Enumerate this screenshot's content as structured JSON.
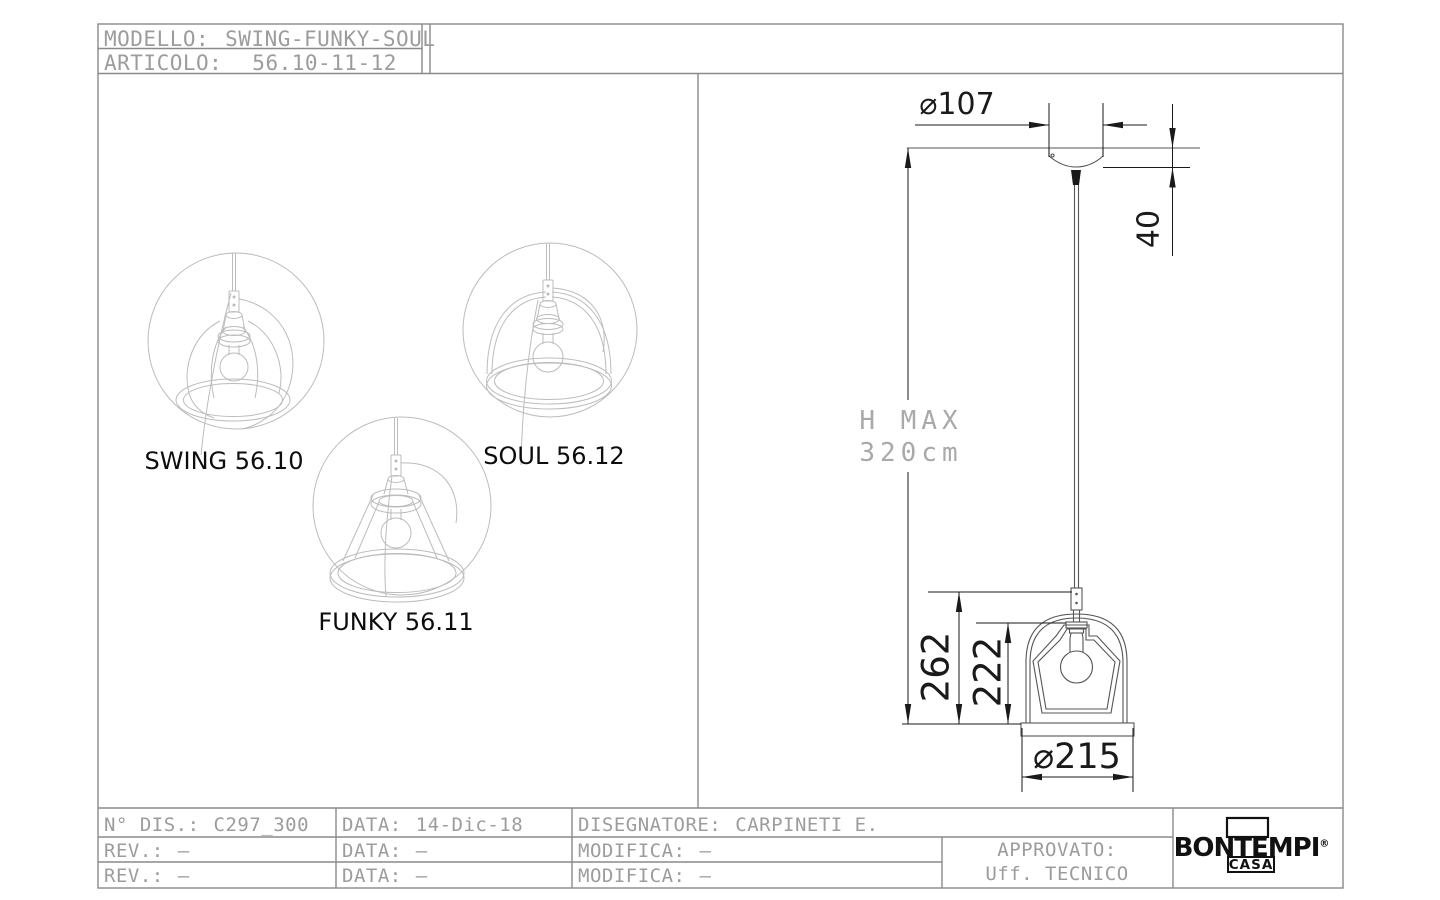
{
  "sheet": {
    "header": {
      "modello_label": "MODELLO:",
      "modello_value": "SWING-FUNKY-SOUL",
      "articolo_label": "ARTICOLO:",
      "articolo_value": "56.10-11-12"
    },
    "products": [
      {
        "label": "SWING 56.10"
      },
      {
        "label": "SOUL 56.12"
      },
      {
        "label": "FUNKY 56.11"
      }
    ],
    "dims": {
      "canopy_diameter": "⌀107",
      "canopy_drop": "40",
      "hmax_line1": "H MAX",
      "hmax_line2": "320cm",
      "height_total": "262",
      "height_glass": "222",
      "base_diameter": "⌀215"
    },
    "title_block": {
      "r1c1_label": "N° DIS.:",
      "r1c1_value": "C297_300",
      "r1c2_label": "DATA:",
      "r1c2_value": "14-Dic-18",
      "r1c3_label": "DISEGNATORE:",
      "r1c3_value": "CARPINETI E.",
      "r2c1_label": "REV.:",
      "r2c1_value": "–",
      "r2c2_label": "DATA:",
      "r2c2_value": "–",
      "r2c3_label": "MODIFICA:",
      "r2c3_value": "–",
      "r3c1_label": "REV.:",
      "r3c1_value": "–",
      "r3c2_label": "DATA:",
      "r3c2_value": "–",
      "r3c3_label": "MODIFICA:",
      "r3c3_value": "–",
      "approved_label": "APPROVATO:",
      "approved_value": "Uff. TECNICO"
    },
    "logo": {
      "brand": "BONTEMPI",
      "reg": "®",
      "sub": "CASA"
    },
    "colors": {
      "frame_gray": "#8a8a8a",
      "cad_text_gray": "#9c9c9c",
      "sketch_gray": "#bcbcbc",
      "drawing_gray": "#555555",
      "ink_black": "#1a1a1a"
    }
  }
}
